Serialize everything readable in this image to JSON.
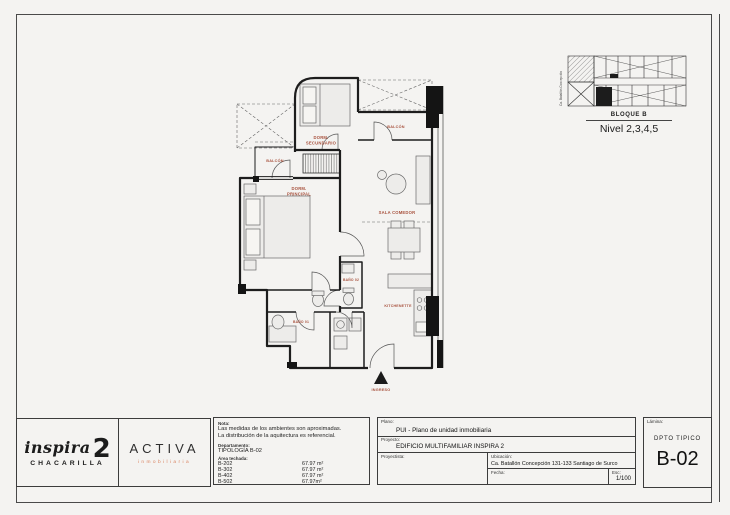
{
  "keyplan": {
    "bloque": "BLOQUE B",
    "nivel": "Nivel 2,3,4,5",
    "street": "Ca. Batallón Concepción"
  },
  "plan": {
    "rooms": {
      "balcon1": "BALCÓN",
      "dorm2_l1": "DORM.",
      "dorm2_l2": "SECUNDARIO",
      "balcon2": "BALCÓN",
      "dorm1_l1": "DORM.",
      "dorm1_l2": "PRINCIPAL",
      "sala": "SALA COMEDOR",
      "bano2": "BAÑO 02",
      "kitchenette": "KITCHENETTE",
      "bano1": "BAÑO 01",
      "ingreso": "INGRESO"
    }
  },
  "logos": {
    "inspira_word": "inspira",
    "inspira_num": "2",
    "inspira_sub": "CHACARILLA",
    "activa": "ACTIVA",
    "activa_sub": "inmobiliaria"
  },
  "notes": {
    "label": "Nota:",
    "line1": "Las medidas de los ambientes son aproximadas.",
    "line2": "La distribución de la aquitectura es referencial.",
    "dept_label": "Departamento:",
    "tipologia": "TIPOLOGÍA B-02",
    "area_label": "Área techada:",
    "units": [
      {
        "code": "B-202",
        "area": "67.97 m²"
      },
      {
        "code": "B-302",
        "area": "67.97 m²"
      },
      {
        "code": "B-402",
        "area": "67.97 m²"
      },
      {
        "code": "B-502",
        "area": "67.97m²"
      }
    ]
  },
  "titleblock": {
    "plano_label": "Plano:",
    "plano": "PUI - Plano de unidad inmobiliaria",
    "proyecto_label": "Proyecto:",
    "proyecto": "EDIFICIO MULTIFAMILIAR INSPIRA 2",
    "proyectista_label": "Proyectista:",
    "ubicacion_label": "Ubicación:",
    "ubicacion": "Ca. Batallón Concepción 131-133 Santiago de Surco",
    "fecha_label": "Fecha:",
    "esc_label": "Esc:",
    "esc": "1/100"
  },
  "sheetid": {
    "lamina_label": "Lámina:",
    "dpto": "DPTO TIPICO",
    "code": "B-02"
  },
  "colors": {
    "label_red": "#a8523e",
    "accent_orange": "#d9825f"
  }
}
